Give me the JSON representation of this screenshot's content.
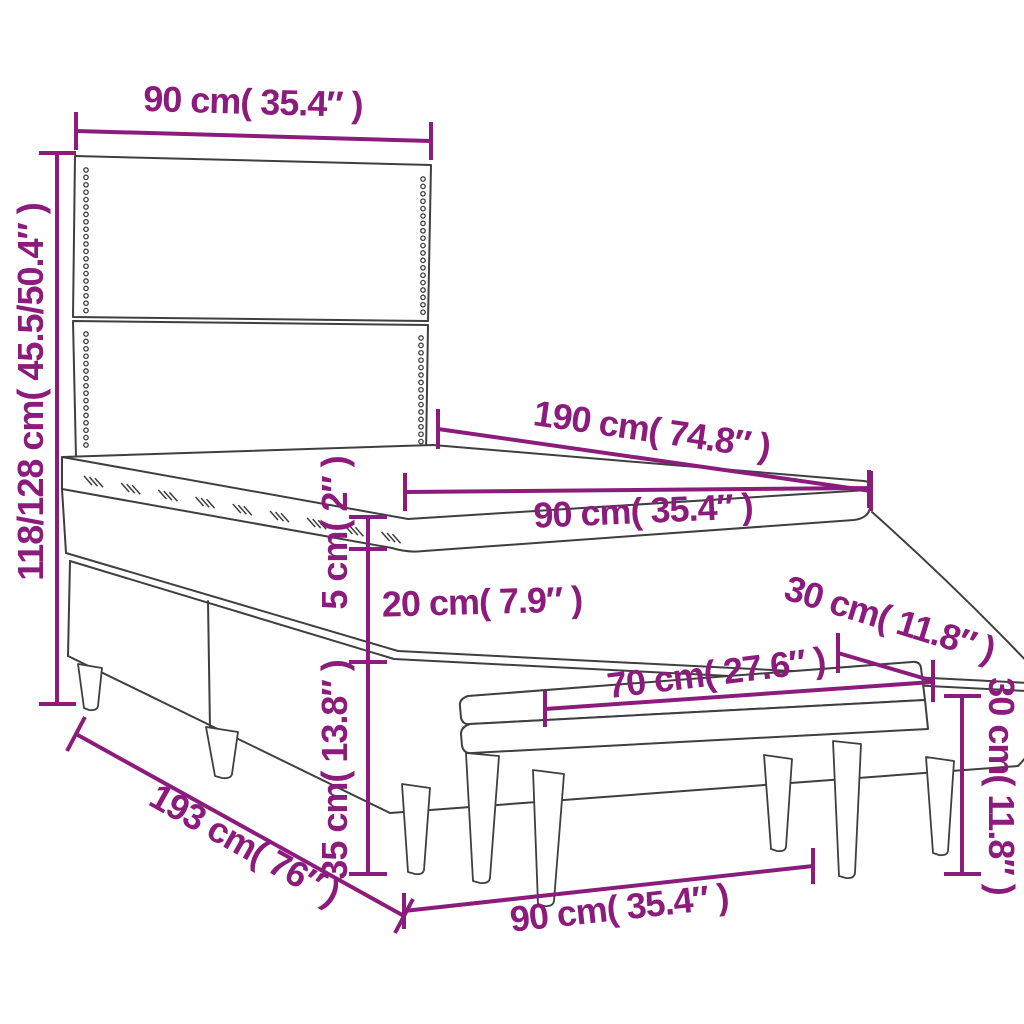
{
  "diagram": {
    "subject": "Box spring bed with studded headboard, pillow-top mattress and upholstered bench - dimension drawing",
    "colors": {
      "dimension_accent": "#8C1C7C",
      "outline": "#3F3F3F",
      "background": "#FFFFFF"
    }
  },
  "dims": {
    "headboard_width": "90 cm( 35.4″ )",
    "overall_height": "118/128 cm( 45.5/50.4″ )",
    "bed_length": "190 cm( 74.8″ )",
    "mattress_width": "90 cm( 35.4″ )",
    "topper_height": "5 cm( 2″ )",
    "mattress_height": "20 cm( 7.9″ )",
    "base_height": "35 cm( 13.8″ )",
    "floor_length": "193 cm( 76″ )",
    "floor_width": "90 cm( 35.4″ )",
    "bench_length": "70 cm( 27.6″ )",
    "bench_depth": "30 cm( 11.8″ )",
    "bench_height": "30 cm( 11.8″ )"
  }
}
